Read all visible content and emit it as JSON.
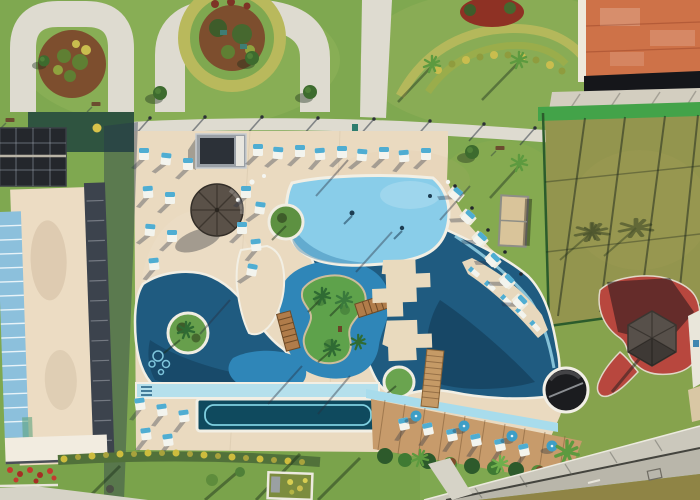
{
  "scene": {
    "type": "aerial-drone-photograph",
    "description": "Aerial top-down view of a resort: free-form swimming pool with lazy river and palm island, cream pool deck with sun loungers, thatched umbrellas, lap pool, wooden sun deck, apartment tower with solar panels, gardens with arched paths, sports court, terracotta clubhouse roof, red playground with gazebo and a street at bottom right",
    "palette": {
      "grass": "#7FA850",
      "grass_light": "#8FB35A",
      "grass_olive": "#8C9A4E",
      "deck": "#EADAC0",
      "path": "#DEDBD0",
      "turf_shade": "#2F5440",
      "mulch": "#7D4E2E",
      "hedge": "#B9B95C",
      "pool_light": "#89CDE9",
      "pool_deep": "#1F5B80",
      "river": "#2F86B8",
      "shelf": "#B5E0EC",
      "lap_pool": "#0F4A5E",
      "island_green": "#5EA24B",
      "wood_deck": "#C79B6B",
      "roof_terracotta": "#CE7248",
      "court_grass": "#93954E",
      "fence_green": "#43A349",
      "playground_red": "#B8473E",
      "road_gray": "#B9B6AA",
      "sidewalk_gray": "#CBC8BC",
      "building_roof": "#ECDCC3",
      "glass_blue": "#8CC0DC",
      "solar_dark": "#24272C",
      "building_trim": "#3C434D",
      "umbrella_thatch": "#5A5148",
      "gazebo_thatch": "#57504A",
      "lounger_blue": "#4FADD2",
      "white_trim": "#F2EFE4",
      "flower_yellow": "#C9BD4E",
      "flower_red": "#C23B2F",
      "shadow": "rgba(38,52,78,0.40)"
    },
    "features": [
      "garden arch paths",
      "circular flower beds",
      "promenade with lamps and benches",
      "apartment tower rooftop",
      "solar panels",
      "pool deck",
      "thatched umbrella",
      "poolside cabana",
      "sun loungers",
      "shallow main pool",
      "deep pool",
      "lazy river",
      "palm island",
      "wooden footbridges",
      "round planter islands",
      "swim-up ledge loungers",
      "lap pool",
      "wooden sun deck with blue umbrellas",
      "round platform",
      "sports court with green fence",
      "clubhouse terracotta roof",
      "red playground",
      "thatched gazebo",
      "street and sidewalk"
    ]
  }
}
